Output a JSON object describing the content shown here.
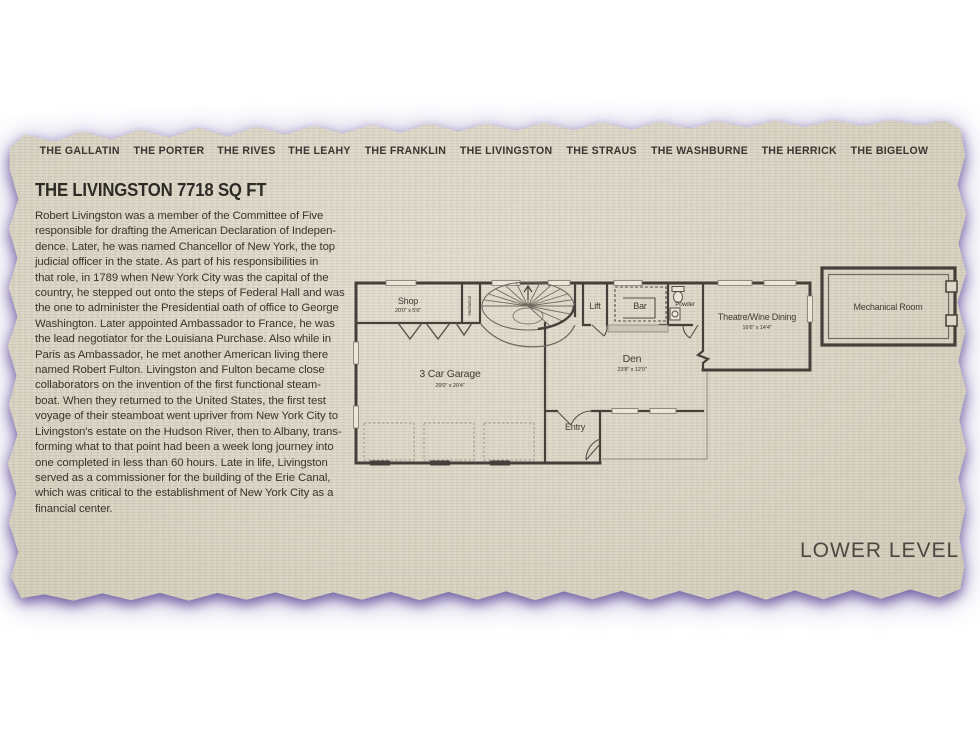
{
  "nav": {
    "items": [
      {
        "label": "THE GALLATIN"
      },
      {
        "label": "THE PORTER"
      },
      {
        "label": "THE RIVES"
      },
      {
        "label": "THE LEAHY"
      },
      {
        "label": "THE FRANKLIN"
      },
      {
        "label": "THE LIVINGSTON"
      },
      {
        "label": "THE STRAUS"
      },
      {
        "label": "THE WASHBURNE"
      },
      {
        "label": "THE HERRICK"
      },
      {
        "label": "THE BIGELOW"
      }
    ]
  },
  "page": {
    "title": "THE LIVINGSTON 7718 SQ FT",
    "paragraph": "Robert Livingston was a member of the Committee of Five\nresponsible for drafting the American Declaration of Indepen-\ndence. Later, he was named Chancellor of New York, the top\njudicial officer in the state. As part of his responsibilities in\nthat role, in 1789 when New York City was the capital of the\ncountry, he stepped out onto the steps of Federal Hall and was\nthe one to administer the Presidential oath of office to George\nWashington. Later appointed Ambassador to France, he was\nthe lead negotiator for the Louisiana Purchase. Also while in\nParis as Ambassador, he met another American living there\nnamed Robert Fulton. Livingston and Fulton became close\ncollaborators on the invention of the first functional steam-\nboat. When they returned to the United States, the first test\nvoyage of their steamboat went upriver from New York City to\nLivingston's estate on the Hudson River, then to Albany, trans-\nforming what to that point had been a week long journey into\none completed in less than 60 hours. Late in life, Livingston\nserved as a commissioner for the building of the Erie Canal,\nwhich was critical to the establishment of New York City as a\nfinancial center.",
    "level_label": "LOWER LEVEL"
  },
  "floorplan": {
    "rooms": {
      "shop": {
        "name": "Shop",
        "dims": "20'0\" x 5'6\""
      },
      "closet": {
        "name": "Mechanical"
      },
      "lift": {
        "name": "Lift"
      },
      "bar": {
        "name": "Bar"
      },
      "powder": {
        "name": "Powder"
      },
      "theatre": {
        "name": "Theatre/Wine Dining",
        "dims": "16'6\" x 14'4\""
      },
      "den": {
        "name": "Den",
        "dims": "23'8\" x 12'0\""
      },
      "garage": {
        "name": "3 Car Garage",
        "dims": "29'0\" x 20'4\""
      },
      "entry": {
        "name": "Entry"
      },
      "mechanical_room": {
        "name": "Mechanical Room"
      }
    }
  },
  "colors": {
    "paper": "#dcd7c7",
    "glow_purple": "#6a579e",
    "wall": "#45413a",
    "text_dark": "#39352d"
  }
}
